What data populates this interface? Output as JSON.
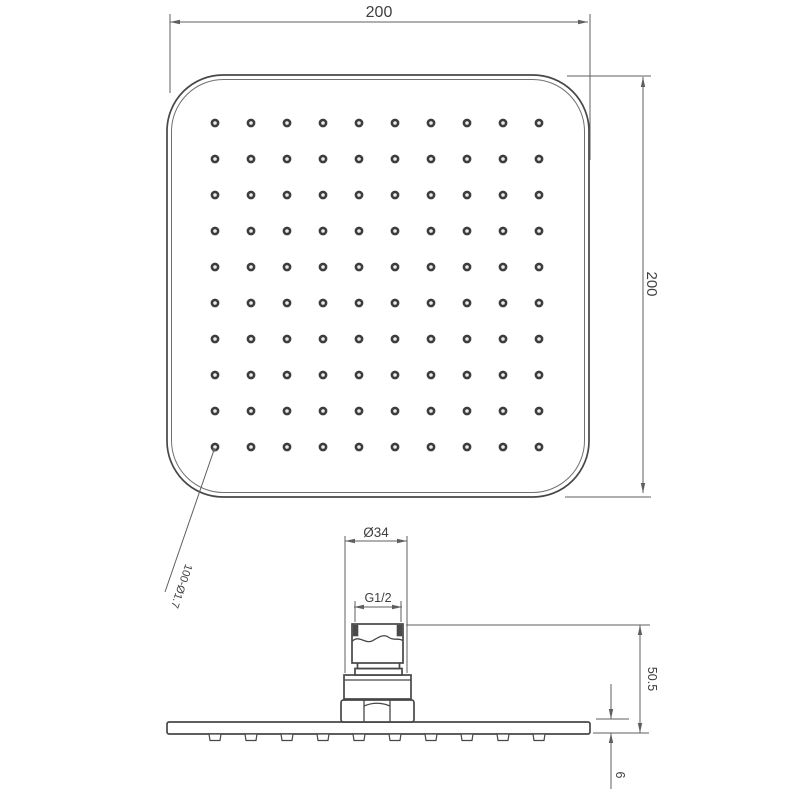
{
  "top_view": {
    "width_dimension": "200",
    "height_dimension": "200",
    "holes_label": "100-Ø1.7",
    "holes_grid": {
      "rows": 10,
      "cols": 10,
      "total_holes": 100
    }
  },
  "side_view": {
    "connector_diameter_label": "Ø34",
    "thread_label": "G1/2",
    "height_label": "50.5",
    "plate_thickness_label": "6",
    "nozzle_count": 10
  },
  "colors": {
    "background": "#ffffff",
    "outline": "#474747",
    "dimension_line": "#5f5f5f",
    "text": "#3f3f3f",
    "hole_ring": "#3d3d3d",
    "thread_fill": "#4a4a4a"
  }
}
